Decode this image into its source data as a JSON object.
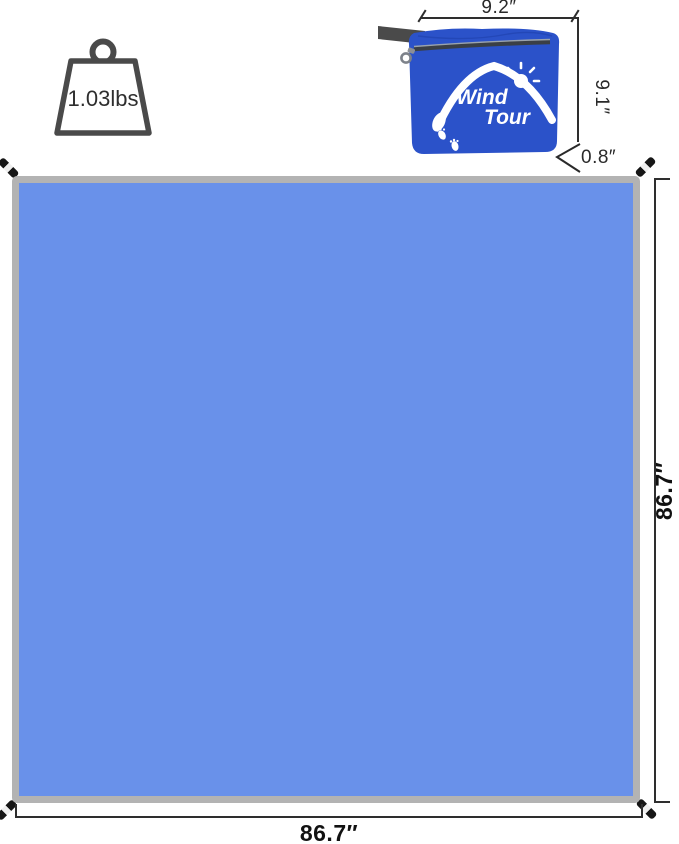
{
  "product": {
    "weight_label": "1.03lbs",
    "brand": {
      "line1": "Wind",
      "line2": "Tour"
    }
  },
  "dimensions": {
    "pouch_width": "9.2″",
    "pouch_height": "9.1″",
    "pouch_depth": "0.8″",
    "tarp_height": "86.7″",
    "tarp_width": "86.7″"
  },
  "colors": {
    "tarp_fill": "#6991EA",
    "tarp_border": "#B3B3B3",
    "pouch_blue": "#2B52C9",
    "strap_gray": "#4A4A4A",
    "dimension_line": "#2E2E2E",
    "logo_white": "#FFFFFF"
  },
  "icons": {
    "weight": "weight-icon",
    "sun": "sun-icon",
    "footprints": "footprints-icon",
    "zipper_pull": "zipper-pull-icon",
    "stakes": "tarp-stake-icon",
    "depth_chevron": "depth-chevron-icon"
  }
}
